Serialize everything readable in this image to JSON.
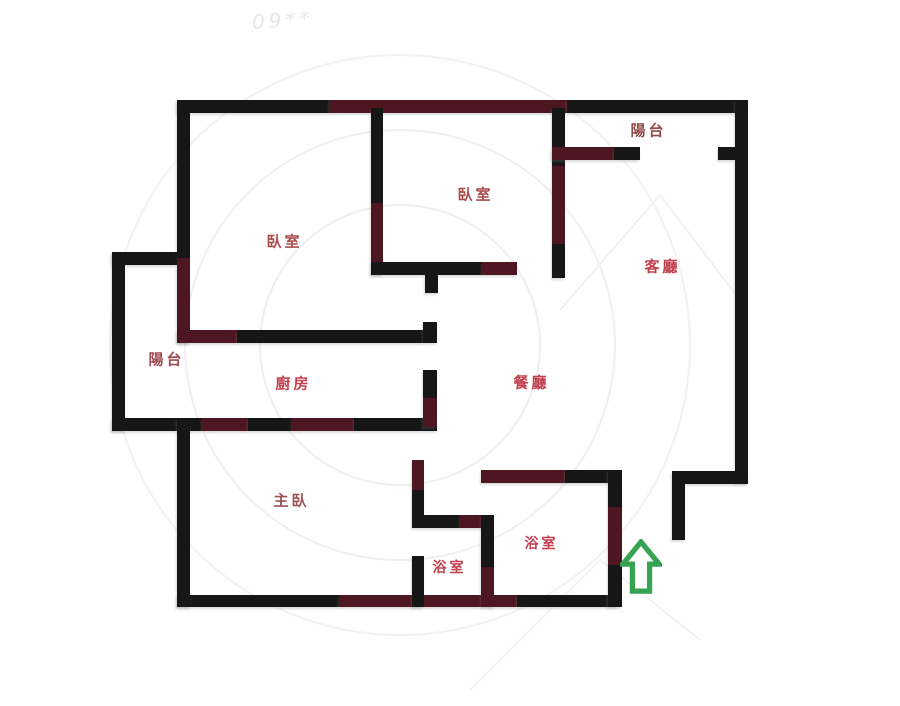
{
  "floorplan": {
    "title": "apartment-floor-plan",
    "background": "#ffffff",
    "wall_colors": {
      "black": "#161616",
      "maroon": "#4e1620"
    },
    "watermark": {
      "text": "09**",
      "color": "#e7e7e7",
      "arc_color": "#f0eeee"
    },
    "rooms": [
      {
        "label": "陽台",
        "x": 647,
        "y": 130,
        "color": "#8e4a46",
        "size": 15
      },
      {
        "label": "臥室",
        "x": 474,
        "y": 194,
        "color": "#a74b4b",
        "size": 15
      },
      {
        "label": "臥室",
        "x": 283,
        "y": 241,
        "color": "#a74b4b",
        "size": 15
      },
      {
        "label": "客廳",
        "x": 661,
        "y": 266,
        "color": "#c13f4e",
        "size": 15
      },
      {
        "label": "陽台",
        "x": 165,
        "y": 359,
        "color": "#9c4a50",
        "size": 15
      },
      {
        "label": "廚房",
        "x": 292,
        "y": 383,
        "color": "#c13f4e",
        "size": 15
      },
      {
        "label": "餐廳",
        "x": 530,
        "y": 382,
        "color": "#c13f4e",
        "size": 15
      },
      {
        "label": "主臥",
        "x": 290,
        "y": 500,
        "color": "#9c5358",
        "size": 15
      },
      {
        "label": "浴室",
        "x": 448,
        "y": 567,
        "color": "#c13f4e",
        "size": 14
      },
      {
        "label": "浴室",
        "x": 540,
        "y": 543,
        "color": "#c13f4e",
        "size": 14
      }
    ],
    "walls": [
      {
        "x": 177,
        "y": 100,
        "w": 152,
        "h": 13,
        "c": "black"
      },
      {
        "x": 329,
        "y": 100,
        "w": 238,
        "h": 13,
        "c": "maroon"
      },
      {
        "x": 567,
        "y": 100,
        "w": 181,
        "h": 13,
        "c": "black"
      },
      {
        "x": 735,
        "y": 100,
        "w": 13,
        "h": 383,
        "c": "black"
      },
      {
        "x": 672,
        "y": 471,
        "w": 76,
        "h": 13,
        "c": "black"
      },
      {
        "x": 672,
        "y": 484,
        "w": 13,
        "h": 56,
        "c": "black"
      },
      {
        "x": 177,
        "y": 595,
        "w": 162,
        "h": 12,
        "c": "black"
      },
      {
        "x": 339,
        "y": 595,
        "w": 178,
        "h": 12,
        "c": "maroon"
      },
      {
        "x": 517,
        "y": 595,
        "w": 100,
        "h": 12,
        "c": "black"
      },
      {
        "x": 177,
        "y": 100,
        "w": 13,
        "h": 158,
        "c": "black"
      },
      {
        "x": 177,
        "y": 258,
        "w": 13,
        "h": 85,
        "c": "maroon"
      },
      {
        "x": 112,
        "y": 252,
        "w": 65,
        "h": 13,
        "c": "black"
      },
      {
        "x": 112,
        "y": 252,
        "w": 13,
        "h": 179,
        "c": "black"
      },
      {
        "x": 112,
        "y": 418,
        "w": 90,
        "h": 13,
        "c": "black"
      },
      {
        "x": 202,
        "y": 418,
        "w": 46,
        "h": 13,
        "c": "maroon"
      },
      {
        "x": 248,
        "y": 418,
        "w": 44,
        "h": 13,
        "c": "black"
      },
      {
        "x": 292,
        "y": 418,
        "w": 62,
        "h": 13,
        "c": "maroon"
      },
      {
        "x": 354,
        "y": 418,
        "w": 83,
        "h": 13,
        "c": "black"
      },
      {
        "x": 177,
        "y": 418,
        "w": 13,
        "h": 189,
        "c": "black"
      },
      {
        "x": 371,
        "y": 108,
        "w": 12,
        "h": 95,
        "c": "black"
      },
      {
        "x": 371,
        "y": 203,
        "w": 12,
        "h": 72,
        "c": "maroon"
      },
      {
        "x": 371,
        "y": 262,
        "w": 111,
        "h": 13,
        "c": "black"
      },
      {
        "x": 482,
        "y": 262,
        "w": 35,
        "h": 13,
        "c": "maroon"
      },
      {
        "x": 425,
        "y": 275,
        "w": 13,
        "h": 18,
        "c": "black"
      },
      {
        "x": 552,
        "y": 108,
        "w": 13,
        "h": 58,
        "c": "black"
      },
      {
        "x": 552,
        "y": 166,
        "w": 13,
        "h": 78,
        "c": "maroon"
      },
      {
        "x": 552,
        "y": 244,
        "w": 13,
        "h": 34,
        "c": "black"
      },
      {
        "x": 552,
        "y": 147,
        "w": 62,
        "h": 13,
        "c": "maroon"
      },
      {
        "x": 614,
        "y": 147,
        "w": 26,
        "h": 13,
        "c": "black"
      },
      {
        "x": 718,
        "y": 147,
        "w": 17,
        "h": 13,
        "c": "black"
      },
      {
        "x": 177,
        "y": 330,
        "w": 60,
        "h": 13,
        "c": "maroon"
      },
      {
        "x": 237,
        "y": 330,
        "w": 186,
        "h": 13,
        "c": "black"
      },
      {
        "x": 423,
        "y": 322,
        "w": 14,
        "h": 21,
        "c": "black"
      },
      {
        "x": 423,
        "y": 370,
        "w": 14,
        "h": 28,
        "c": "black"
      },
      {
        "x": 423,
        "y": 398,
        "w": 14,
        "h": 29,
        "c": "maroon"
      },
      {
        "x": 412,
        "y": 460,
        "w": 12,
        "h": 30,
        "c": "maroon"
      },
      {
        "x": 412,
        "y": 490,
        "w": 12,
        "h": 25,
        "c": "black"
      },
      {
        "x": 412,
        "y": 515,
        "w": 48,
        "h": 13,
        "c": "black"
      },
      {
        "x": 460,
        "y": 515,
        "w": 33,
        "h": 13,
        "c": "maroon"
      },
      {
        "x": 412,
        "y": 556,
        "w": 12,
        "h": 51,
        "c": "black"
      },
      {
        "x": 481,
        "y": 515,
        "w": 13,
        "h": 52,
        "c": "black"
      },
      {
        "x": 481,
        "y": 567,
        "w": 13,
        "h": 40,
        "c": "maroon"
      },
      {
        "x": 481,
        "y": 470,
        "w": 84,
        "h": 13,
        "c": "maroon"
      },
      {
        "x": 565,
        "y": 470,
        "w": 57,
        "h": 13,
        "c": "black"
      },
      {
        "x": 608,
        "y": 470,
        "w": 14,
        "h": 37,
        "c": "black"
      },
      {
        "x": 608,
        "y": 507,
        "w": 14,
        "h": 58,
        "c": "maroon"
      },
      {
        "x": 608,
        "y": 565,
        "w": 14,
        "h": 42,
        "c": "black"
      }
    ],
    "entrance_arrow": {
      "x": 620,
      "y": 539,
      "width": 42,
      "height": 56,
      "color": "#35a352",
      "direction": "up"
    }
  }
}
